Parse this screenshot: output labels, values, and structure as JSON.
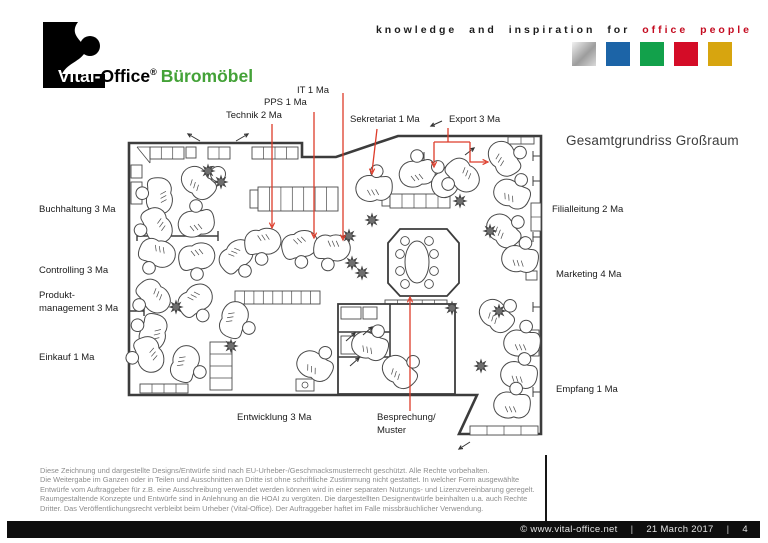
{
  "header": {
    "logo": {
      "white_part": "Vital-",
      "black_part": "Office",
      "reg": "®",
      "product": "Büromöbel"
    },
    "tagline": {
      "black": "knowledge and inspiration for",
      "red": "office people"
    },
    "brand_colors": {
      "green": "#44a238",
      "red": "#c40b20",
      "squares": [
        "silver-gradient",
        "#1c64a7",
        "#12a14b",
        "#d40c27",
        "#d7a50f"
      ]
    }
  },
  "plan": {
    "title": "Gesamtgrundriss Großraum",
    "labels": {
      "technik": "Technik 2 Ma",
      "pps": "PPS 1 Ma",
      "it": "IT 1 Ma",
      "sekretariat": "Sekretariat 1 Ma",
      "export": "Export 3 Ma",
      "buchhaltung": "Buchhaltung 3 Ma",
      "controlling": "Controlling 3 Ma",
      "produkt_line1": "Produkt-",
      "produkt_line2": "management 3 Ma",
      "einkauf": "Einkauf 1 Ma",
      "filialleitung": "Filialleitung 2 Ma",
      "marketing": "Marketing 4 Ma",
      "empfang": "Empfang 1 Ma",
      "entwicklung": "Entwicklung 3 Ma",
      "besprechung_line1": "Besprechung/",
      "besprechung_line2": "Muster"
    },
    "annotation_color": "#dd3c2a"
  },
  "disclaimer": {
    "lines": [
      "Diese Zeichnung und dargestellte Designs/Entwürfe sind nach EU-Urheber-/Geschmacksmusterrecht geschützt. Alle Rechte vorbehalten.",
      "Die Weitergabe im Ganzen oder in Teilen und Ausschnitten an Dritte ist ohne schriftliche Zustimmung nicht gestattet. In welcher Form ausgewählte",
      "Entwürfe vom Auftraggeber für z.B. eine Ausschreibung verwendet werden können wird in einer separaten Nutzungs- und Lizenzvereinbarung geregelt.",
      "Raumgestaltende Konzepte und Entwürfe sind in Anlehnung an die HOAI zu vergüten. Die dargestellten Designentwürfe beinhalten u.a. auch Rechte",
      "Dritter. Das Veröffentlichungsrecht verbleibt beim Urheber (Vital-Office). Der Auftraggeber haftet im Falle missbräuchlicher Verwendung."
    ]
  },
  "footer": {
    "copyright": "©  www.vital-office.net",
    "sep": "|",
    "date": "21 March 2017",
    "page": "4"
  }
}
